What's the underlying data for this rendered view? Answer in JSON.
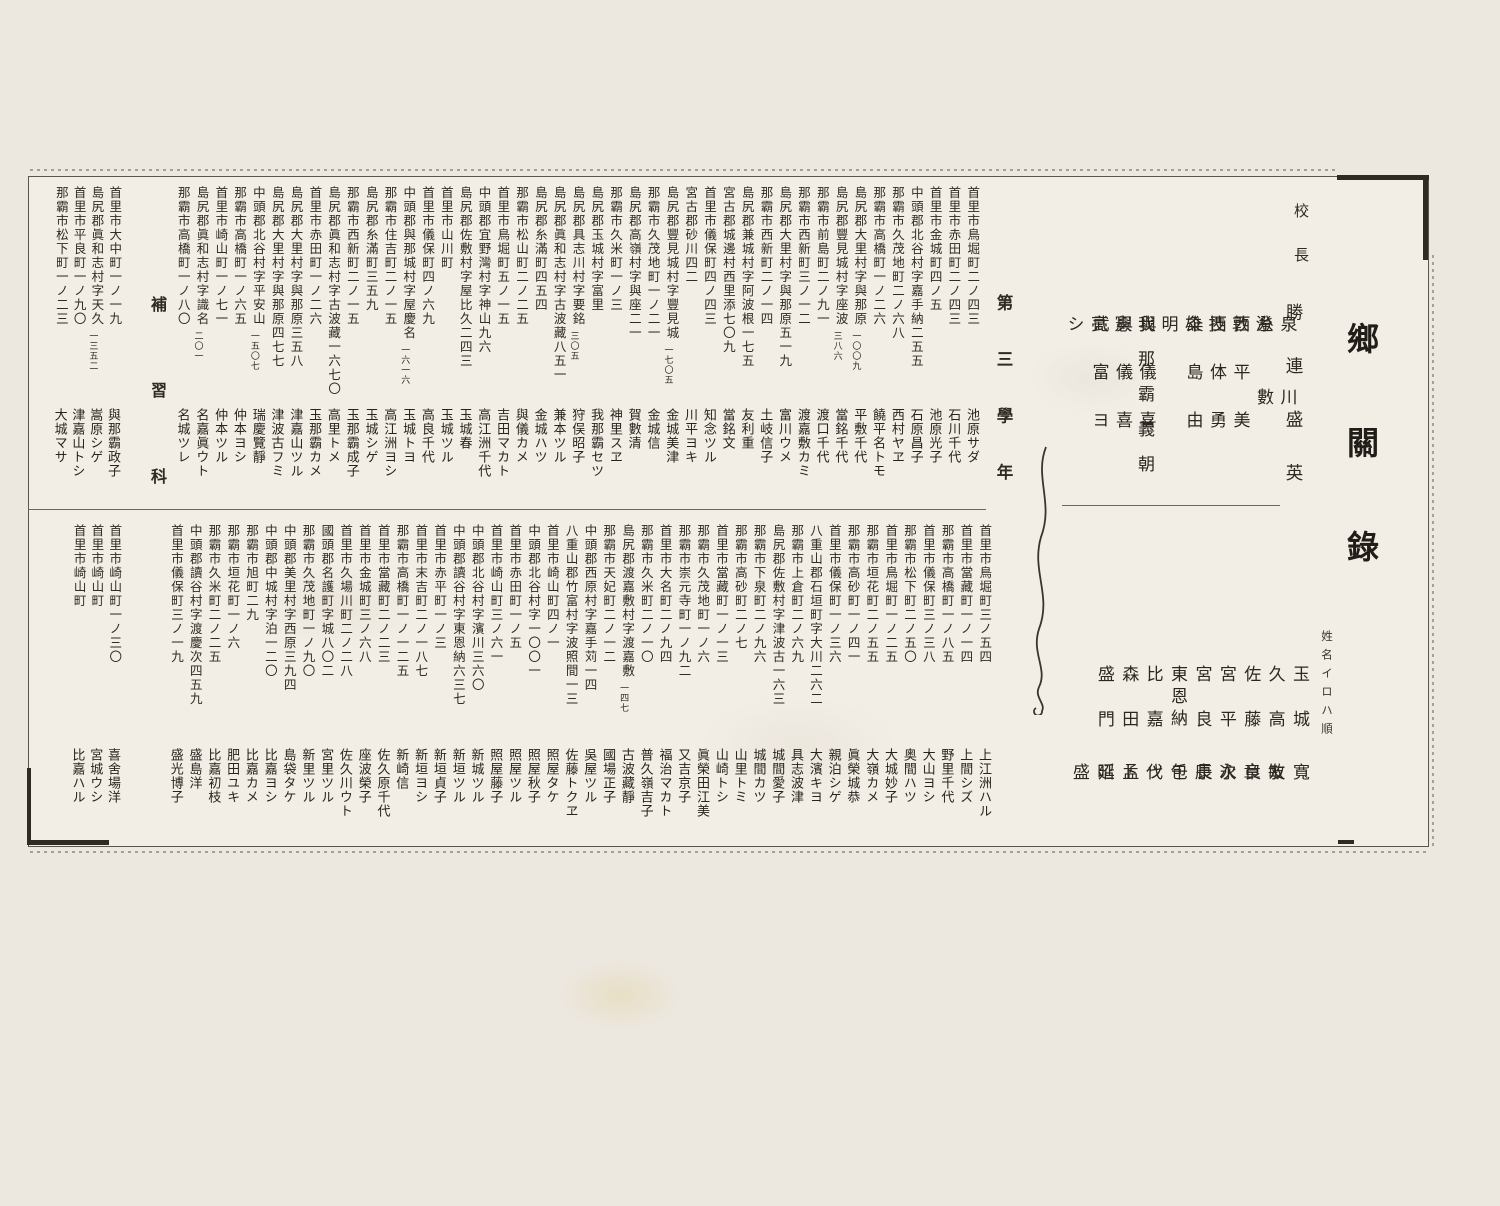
{
  "title": "鄉關錄",
  "iroha_note": "姓名イロハ順",
  "principal": {
    "label": "校長",
    "name": "勝連盛英"
  },
  "staff_row1": [
    "泉川澄",
    "糸數敦",
    "西平美技",
    "西体勇雄",
    "粂島由明",
    "我那霸義朝",
    "與儀喜憲",
    "與儀喜亮",
    "武富ヨシ"
  ],
  "staff_row2": [
    {
      "f": "玉城",
      "g": "寬敏"
    },
    {
      "f": "久高",
      "g": "友章"
    },
    {
      "f": "佐藤",
      "g": "良次"
    },
    {
      "f": "宮平",
      "g": "永康"
    },
    {
      "f": "宮良",
      "g": "長包"
    },
    {
      "f": "東恩納",
      "g": "千代"
    },
    {
      "f": "比嘉",
      "g": "ツト"
    },
    {
      "f": "森田",
      "g": "孟昭"
    },
    {
      "f": "盛門",
      "g": "延盛"
    }
  ],
  "grade_label": "第三學年",
  "hoshu_label": "補習科",
  "band1": [
    {
      "a": "首里市鳥堀町二ノ四三",
      "n": "",
      "name": "池原サダ"
    },
    {
      "a": "首里市赤田町二ノ四三",
      "n": "",
      "name": "石川千代"
    },
    {
      "a": "首里市金城町四ノ五",
      "n": "",
      "name": "池原光子"
    },
    {
      "a": "中頭郡北谷村字嘉手納二五五",
      "n": "",
      "name": "石原昌子"
    },
    {
      "a": "那霸市久茂地町二ノ六八",
      "n": "",
      "name": "西村ヤヱ"
    },
    {
      "a": "那霸市高橋町一ノ二六",
      "n": "",
      "name": "饒平名トモ"
    },
    {
      "a": "島尻郡大里村字與那原",
      "n": "一〇〇九",
      "name": "平敷千代"
    },
    {
      "a": "島尻郡豐見城村字座波",
      "n": "三八六",
      "name": "當銘千代"
    },
    {
      "a": "那霸市前島町二ノ九一",
      "n": "",
      "name": "渡口千代"
    },
    {
      "a": "那霸市西新町三ノ一二",
      "n": "",
      "name": "渡嘉敷カミ"
    },
    {
      "a": "島尻郡大里村字與那原五一九",
      "n": "",
      "name": "富川ウメ"
    },
    {
      "a": "那霸市西新町二ノ一四",
      "n": "",
      "name": "土岐信子"
    },
    {
      "a": "島尻郡兼城村字阿波根一七五",
      "n": "",
      "name": "友利重"
    },
    {
      "a": "宮古郡城邊村西里添七〇九",
      "n": "",
      "name": "當銘文"
    },
    {
      "a": "首里市儀保町四ノ四三",
      "n": "",
      "name": "知念ツル"
    },
    {
      "a": "宮古郡砂川四二",
      "n": "",
      "name": "川平ヨキ"
    },
    {
      "a": "島尻郡豐見城村字豐見城",
      "n": "一七〇五",
      "name": "金城美津"
    },
    {
      "a": "那霸市久茂地町一ノ二一",
      "n": "",
      "name": "金城信"
    },
    {
      "a": "島尻郡高嶺村字與座二一",
      "n": "",
      "name": "賀數清"
    },
    {
      "a": "那霸市久米町一ノ三",
      "n": "",
      "name": "神里スヱ"
    },
    {
      "a": "島尻郡玉城村字富里",
      "n": "",
      "name": "我那霸セツ"
    },
    {
      "a": "島尻郡具志川村字要銘",
      "n": "三〇五",
      "name": "狩俣昭子"
    },
    {
      "a": "島尻郡眞和志村字古波藏八五一",
      "n": "",
      "name": "兼本ツル"
    },
    {
      "a": "島尻郡糸滿町四五四",
      "n": "",
      "name": "金城ハツ"
    },
    {
      "a": "那霸市松山町二ノ二五",
      "n": "",
      "name": "與儀カメ"
    },
    {
      "a": "首里市鳥堀町五ノ一五",
      "n": "",
      "name": "吉田マカト"
    },
    {
      "a": "中頭郡宜野灣村字神山九六",
      "n": "",
      "name": "高江洲千代"
    },
    {
      "a": "島尻郡佐敷村字屋比久二四三",
      "n": "",
      "name": "玉城春"
    },
    {
      "a": "首里市山川町",
      "n": "",
      "name": "玉城ツル"
    },
    {
      "a": "首里市儀保町四ノ六九",
      "n": "",
      "name": "高良千代"
    },
    {
      "a": "中頭郡與那城村字屋慶名",
      "n": "一六一六",
      "name": "玉城トヨ"
    },
    {
      "a": "那霸市住吉町二ノ一五",
      "n": "",
      "name": "高江洲ヨシ"
    },
    {
      "a": "島尻郡糸滿町三五九",
      "n": "",
      "name": "玉城シゲ"
    },
    {
      "a": "那霸市西新町二ノ一五",
      "n": "",
      "name": "玉那霸成子"
    },
    {
      "a": "島尻郡眞和志村字古波藏一六七〇",
      "n": "",
      "name": "高里トメ"
    },
    {
      "a": "首里市赤田町一ノ二六",
      "n": "",
      "name": "玉那霸カメ"
    },
    {
      "a": "島尻郡大里村字與那原三五八",
      "n": "",
      "name": "津嘉山ツル"
    },
    {
      "a": "島尻郡大里村字與那原四七七",
      "n": "",
      "name": "津波古フミ"
    },
    {
      "a": "中頭郡北谷村字平安山",
      "n": "一五〇七",
      "name": "瑞慶覽靜"
    },
    {
      "a": "那霸市高橋町一ノ六五",
      "n": "",
      "name": "仲本ヨシ"
    },
    {
      "a": "首里市崎山町一ノ七一",
      "n": "",
      "name": "仲本ツル"
    },
    {
      "a": "島尻郡眞和志村字識名",
      "n": "二〇一",
      "name": "名嘉眞ウト"
    },
    {
      "a": "那霸市高橋町一ノ八〇",
      "n": "",
      "name": "名城ツレ"
    }
  ],
  "band2": [
    {
      "a": "首里市鳥堀町三ノ五四",
      "n": "",
      "name": "上江洲ハル"
    },
    {
      "a": "首里市當藏町一ノ一四",
      "n": "",
      "name": "上間シズ"
    },
    {
      "a": "那霸市高橋町一ノ八五",
      "n": "",
      "name": "野里千代"
    },
    {
      "a": "首里市儀保町三ノ三八",
      "n": "",
      "name": "大山ヨシ"
    },
    {
      "a": "那霸市松下町二ノ五〇",
      "n": "",
      "name": "奥間ハツ"
    },
    {
      "a": "首里市鳥堀町一ノ二五",
      "n": "",
      "name": "大城妙子"
    },
    {
      "a": "那霸市垣花町二ノ五五",
      "n": "",
      "name": "大嶺カメ"
    },
    {
      "a": "那霸市高砂町一ノ四一",
      "n": "",
      "name": "眞榮城恭"
    },
    {
      "a": "首里市儀保町一ノ三六",
      "n": "",
      "name": "親泊シゲ"
    },
    {
      "a": "八重山郡石垣町字大川二六二",
      "n": "",
      "name": "大濱キヨ"
    },
    {
      "a": "那霸市上倉町二ノ六九",
      "n": "",
      "name": "具志波津"
    },
    {
      "a": "島尻郡佐敷村字津波古一六三",
      "n": "",
      "name": "城間愛子"
    },
    {
      "a": "那霸市下泉町二ノ九六",
      "n": "",
      "name": "城間カツ"
    },
    {
      "a": "那霸市高砂町二ノ七",
      "n": "",
      "name": "山里トミ"
    },
    {
      "a": "首里市當藏町一ノ一三",
      "n": "",
      "name": "山崎トシ"
    },
    {
      "a": "那霸市久茂地町一ノ六",
      "n": "",
      "name": "眞榮田江美"
    },
    {
      "a": "那霸市崇元寺町一ノ九二",
      "n": "",
      "name": "又吉京子"
    },
    {
      "a": "首里市大名町二ノ九四",
      "n": "",
      "name": "福治マカト"
    },
    {
      "a": "那霸市久米町二ノ一〇",
      "n": "",
      "name": "普久嶺吉子"
    },
    {
      "a": "島尻郡渡嘉敷村字渡嘉敷",
      "n": "一四七",
      "name": "古波藏靜"
    },
    {
      "a": "那霸市天妃町二ノ一二",
      "n": "",
      "name": "國場正子"
    },
    {
      "a": "中頭郡西原村字嘉手苅一四",
      "n": "",
      "name": "吳屋ツル"
    },
    {
      "a": "八重山郡竹富村字波照間一三",
      "n": "",
      "name": "佐藤トクヱ"
    },
    {
      "a": "首里市崎山町四ノ一",
      "n": "",
      "name": "照屋タケ"
    },
    {
      "a": "中頭郡北谷村字一〇〇一",
      "n": "",
      "name": "照屋秋子"
    },
    {
      "a": "首里市赤田町一ノ五",
      "n": "",
      "name": "照屋ツル"
    },
    {
      "a": "首里市崎山町三ノ六一",
      "n": "",
      "name": "照屋藤子"
    },
    {
      "a": "中頭郡北谷村字濱川三六〇",
      "n": "",
      "name": "新城ツル"
    },
    {
      "a": "中頭郡讀谷村字東恩納六三七",
      "n": "",
      "name": "新垣ツル"
    },
    {
      "a": "首里市赤平町一ノ三",
      "n": "",
      "name": "新垣貞子"
    },
    {
      "a": "首里市末吉町二ノ一八七",
      "n": "",
      "name": "新垣ヨシ"
    },
    {
      "a": "那霸市高橋町一ノ一二五",
      "n": "",
      "name": "新崎信"
    },
    {
      "a": "首里市當藏町二ノ二三",
      "n": "",
      "name": "佐久原千代"
    },
    {
      "a": "首里市金城町三ノ六八",
      "n": "",
      "name": "座波榮子"
    },
    {
      "a": "首里市久場川町二ノ二八",
      "n": "",
      "name": "佐久川ウト"
    },
    {
      "a": "國頭郡名護町字城八〇二",
      "n": "",
      "name": "宮里ツル"
    },
    {
      "a": "那霸市久茂地町一ノ九〇",
      "n": "",
      "name": "新里ツル"
    },
    {
      "a": "中頭郡美里村字西原三九四",
      "n": "",
      "name": "島袋タケ"
    },
    {
      "a": "中頭郡中城村字泊一二〇",
      "n": "",
      "name": "比嘉ヨシ"
    },
    {
      "a": "那霸市旭町二九",
      "n": "",
      "name": "比嘉カメ"
    },
    {
      "a": "那霸市垣花町一ノ六",
      "n": "",
      "name": "肥田ユキ"
    },
    {
      "a": "那霸市久米町二ノ二五",
      "n": "",
      "name": "比嘉初枝"
    },
    {
      "a": "中頭郡讀谷村字渡慶次四五九",
      "n": "",
      "name": "盛島洋"
    },
    {
      "a": "首里市儀保町三ノ一九",
      "n": "",
      "name": "盛光博子"
    }
  ],
  "hoshu_band1": [
    {
      "a": "首里市大中町一ノ一九",
      "n": "",
      "name": "與那霸政子"
    },
    {
      "a": "島尻郡眞和志村字天久",
      "n": "一三五二",
      "name": "嵩原シゲ"
    },
    {
      "a": "首里市平良町一ノ九〇",
      "n": "",
      "name": "津嘉山トシ"
    },
    {
      "a": "那霸市松下町一ノ二三",
      "n": "",
      "name": "大城マサ"
    }
  ],
  "hoshu_band2": [
    {
      "a": "首里市崎山町一ノ三〇",
      "n": "",
      "name": "喜舍場洋"
    },
    {
      "a": "首里市崎山町",
      "n": "",
      "name": "宮城ウシ"
    },
    {
      "a": "首里市崎山町",
      "n": "",
      "name": "比嘉ハル"
    }
  ]
}
